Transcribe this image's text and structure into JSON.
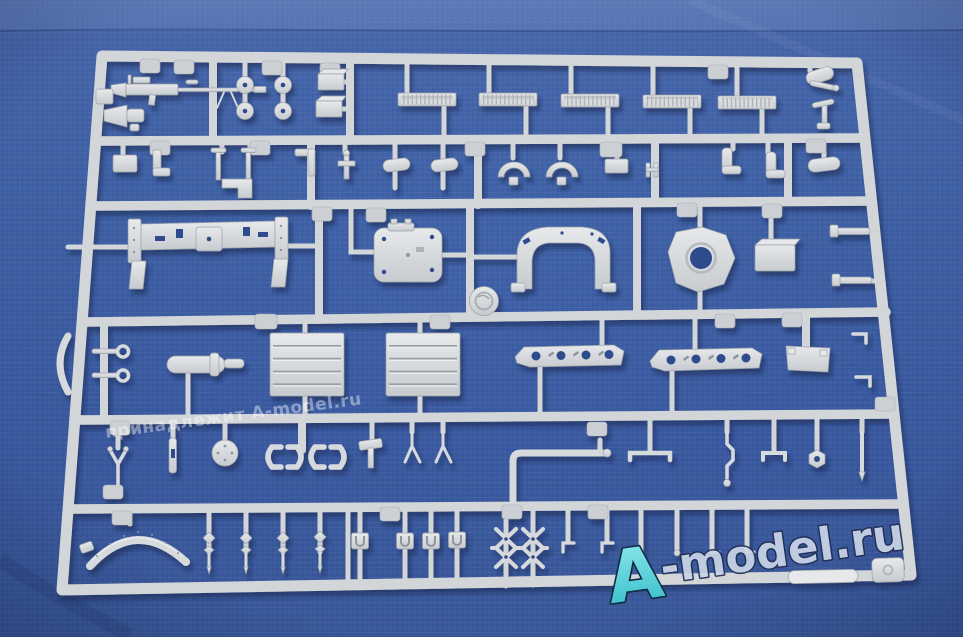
{
  "watermarks": {
    "ownership": "принадлежит A-model.ru",
    "brand_a": "A",
    "brand_rest": "-model.ru",
    "brand_full": "A-model.ru"
  },
  "colors": {
    "fabric_blue": "#3e5fa8",
    "fabric_blue_light": "#5d7cbc",
    "fabric_blue_dark": "#32519c",
    "sprue_plastic": "#d3d6d9",
    "plastic_highlight": "#e8eaec",
    "plastic_shadow": "#9aa1a8",
    "watermark_cyan": "#5ad7dc",
    "watermark_silver_blue": "#c9d4e6",
    "watermark_outline": "#1d2c50"
  },
  "parts_visible": [
    "machine-gun",
    "signal-horn",
    "washer-discs",
    "track-strips",
    "equipment-boxes",
    "chassis-frame",
    "hatch-panel",
    "injection-gate-disc",
    "arched-bracket",
    "ring-plate",
    "storage-box",
    "towing-eyelets",
    "barrel-sleeve",
    "louvered-grilles",
    "perforated-brackets",
    "flat-plate",
    "clamp-pairs",
    "u-brackets",
    "channel-blocks",
    "lattice-braces",
    "fender-arch",
    "bullet-pins",
    "hook-pins",
    "part-number-tabs"
  ]
}
